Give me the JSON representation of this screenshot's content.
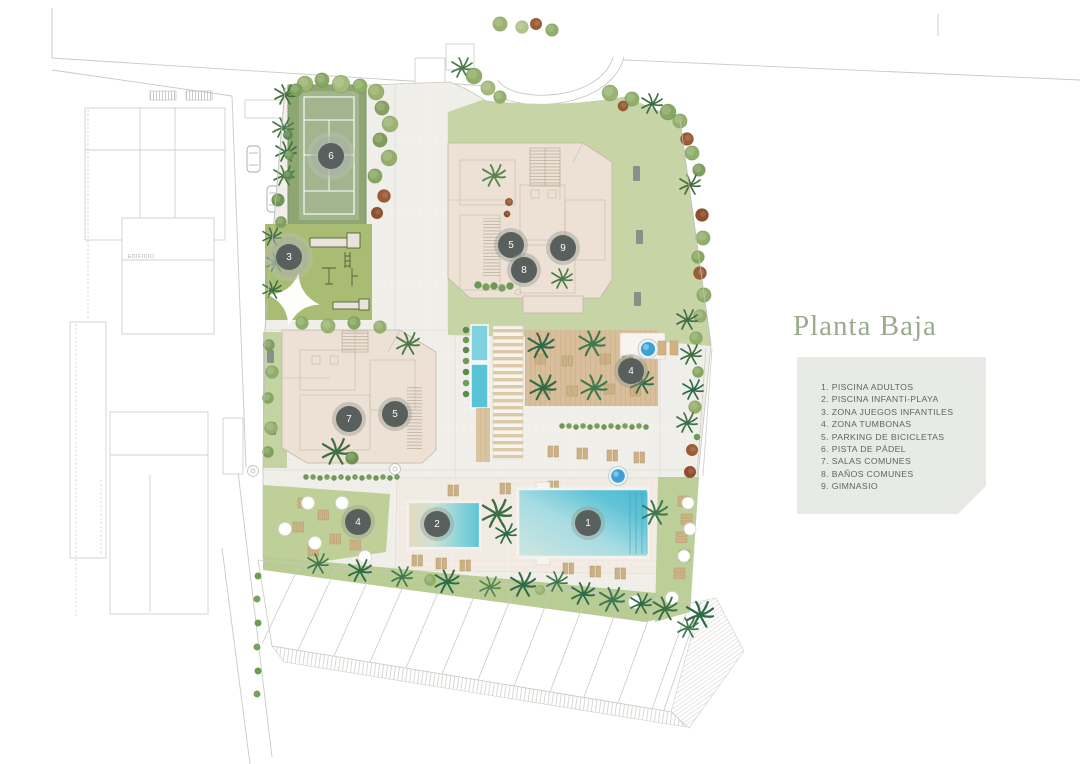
{
  "title": {
    "text": "Planta Baja",
    "color": "#9aab8e"
  },
  "legend": {
    "panel_color": "#e8ebe5",
    "text_color": "#5f665f",
    "items": [
      "1. PISCINA ADULTOS",
      "2. PISCINA INFANTI-PLAYA",
      "3. ZONA JUEGOS INFANTILES",
      "4. ZONA TUMBONAS",
      "5. PARKING DE BICICLETAS",
      "6. PISTA DE PÁDEL",
      "7. SALAS COMUNES",
      "8. BAÑOS COMUNES",
      "9. GIMNASIO"
    ]
  },
  "plan": {
    "neighbor_label": "EDIFICIO",
    "markers": [
      {
        "n": "6",
        "x": 331,
        "y": 156,
        "large": true
      },
      {
        "n": "3",
        "x": 289,
        "y": 257,
        "large": true
      },
      {
        "n": "5",
        "x": 511,
        "y": 245
      },
      {
        "n": "9",
        "x": 563,
        "y": 248
      },
      {
        "n": "8",
        "x": 524,
        "y": 270
      },
      {
        "n": "7",
        "x": 349,
        "y": 419
      },
      {
        "n": "5",
        "x": 395,
        "y": 414
      },
      {
        "n": "4",
        "x": 631,
        "y": 371
      },
      {
        "n": "4",
        "x": 358,
        "y": 522
      },
      {
        "n": "2",
        "x": 437,
        "y": 524
      },
      {
        "n": "1",
        "x": 588,
        "y": 523
      }
    ],
    "colors": {
      "water": "#5ec7d8",
      "lawn": "#c4d3a2",
      "playground": "#a9bc74",
      "court": "#9fb48a",
      "building": "#ece1d4",
      "deck": "#d8be9a",
      "spa": "#3f9fd6"
    }
  }
}
